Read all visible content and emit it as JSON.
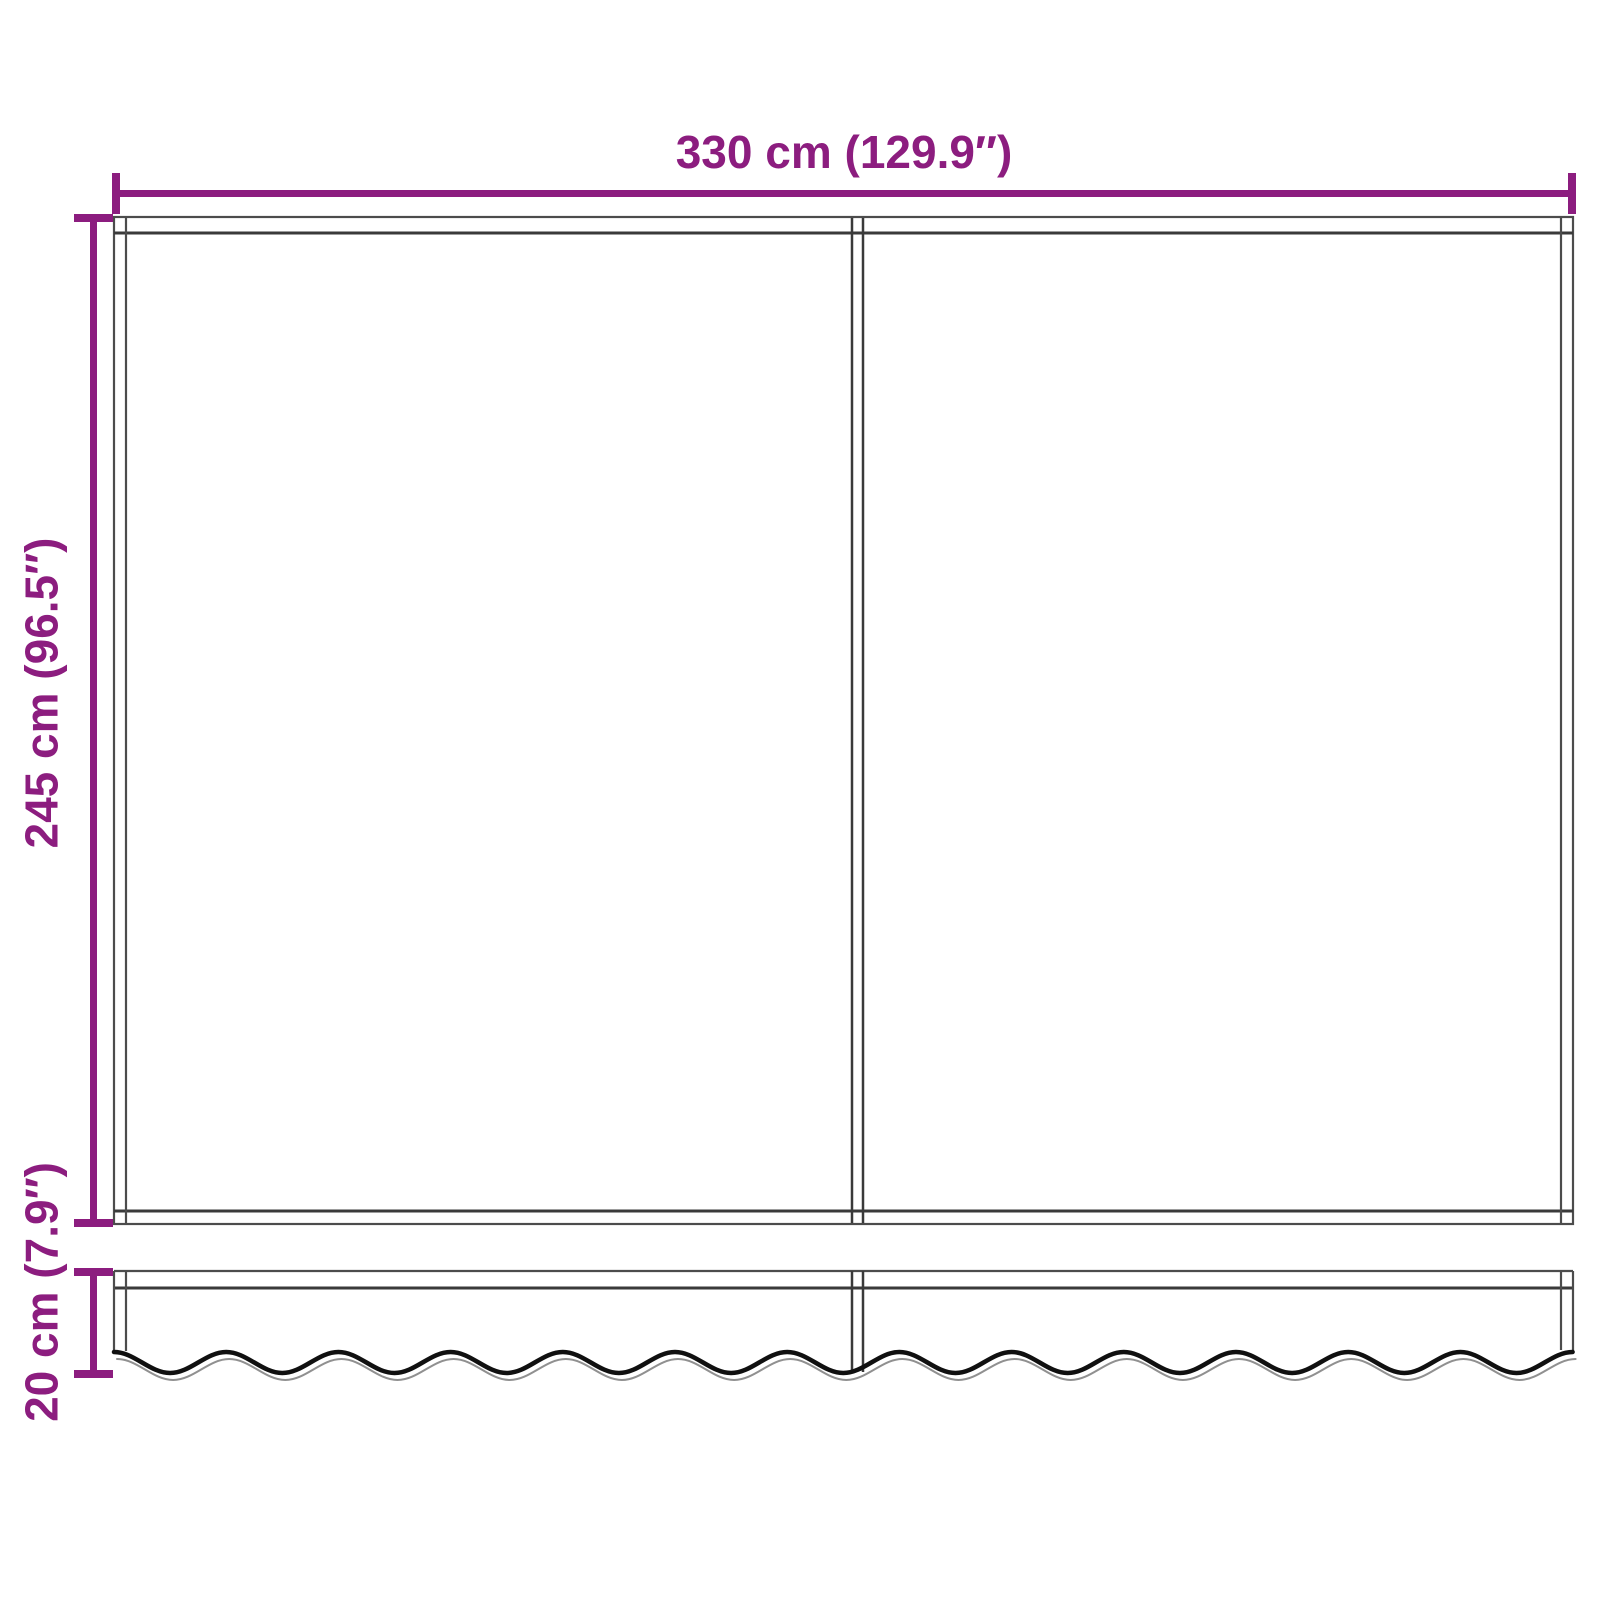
{
  "diagram": {
    "dimensions": {
      "width": {
        "label": "330 cm (129.9″)",
        "value_cm": 330,
        "value_in": 129.9
      },
      "height": {
        "label": "245 cm (96.5″)",
        "value_cm": 245,
        "value_in": 96.5
      },
      "valance": {
        "label": "20 cm (7.9″)",
        "value_cm": 20,
        "value_in": 7.9
      }
    },
    "colors": {
      "dimension_accent": "#8c1d7f",
      "outline_dark": "#3a3a3a",
      "outline_mid": "#4c4c4c",
      "wave_black": "#101010",
      "wave_echo": "#909090",
      "background": "#ffffff"
    }
  }
}
